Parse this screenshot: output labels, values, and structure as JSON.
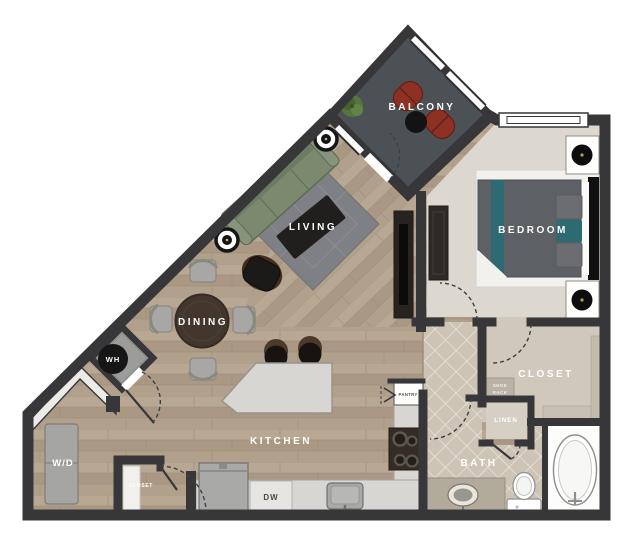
{
  "labels": {
    "balcony": "BALCONY",
    "living": "LIVING",
    "dining": "DINING",
    "kitchen": "KITCHEN",
    "bedroom": "BEDROOM",
    "bath": "BATH",
    "walk_in_closet": "CLOSET",
    "wh": "WH",
    "wd": "W/D",
    "dw": "DW",
    "pantry": "PANTRY",
    "linen": "LINEN",
    "shoe_rack_line1": "SHOE",
    "shoe_rack_line2": "RACK",
    "entry_closet": "CLOSET"
  },
  "palette": {
    "wall": "#37373a",
    "wood": "#b2a08c",
    "carpet": "#dcd8d0",
    "closet_carpet": "#d0c9bb",
    "tile": "#cdc4b6",
    "balcony_floor": "#4c5156",
    "rug": "#7e8085",
    "sofa_green": "#7b8a6e",
    "accent_teal": "#2e6a71",
    "chair_red": "#8d3125",
    "dining_table": "#43362d",
    "counter": "#d7d6d2",
    "appliance": "#a5a5a3",
    "label_light": "#ffffff",
    "label_dark": "#57544e"
  }
}
